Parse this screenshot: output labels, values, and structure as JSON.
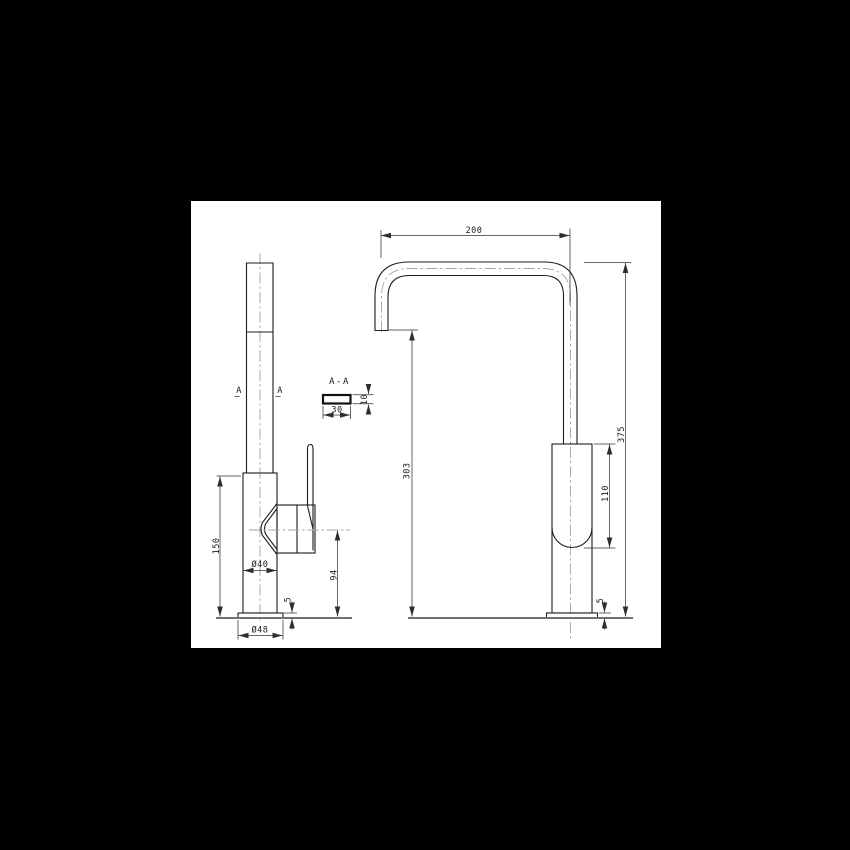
{
  "page": {
    "background_color": "#000000",
    "paper_color": "#ffffff",
    "line_color": "#1c1c1c",
    "dimension_color": "#333333",
    "centerline_color": "#a3a3a3"
  },
  "drawing": {
    "front_view": {
      "body_height": "150",
      "body_diameter": "Ø40",
      "handle_center_height": "94",
      "base_plate_thickness": "5",
      "base_diameter": "Ø48",
      "section_marker_left": "A",
      "section_marker_right": "A"
    },
    "section_view": {
      "label": "A-A",
      "spout_width": "30",
      "spout_thickness": "10"
    },
    "side_view": {
      "spout_reach": "200",
      "outlet_height": "303",
      "overall_height": "375",
      "upper_body_length": "110",
      "base_plate_thickness": "5"
    }
  }
}
